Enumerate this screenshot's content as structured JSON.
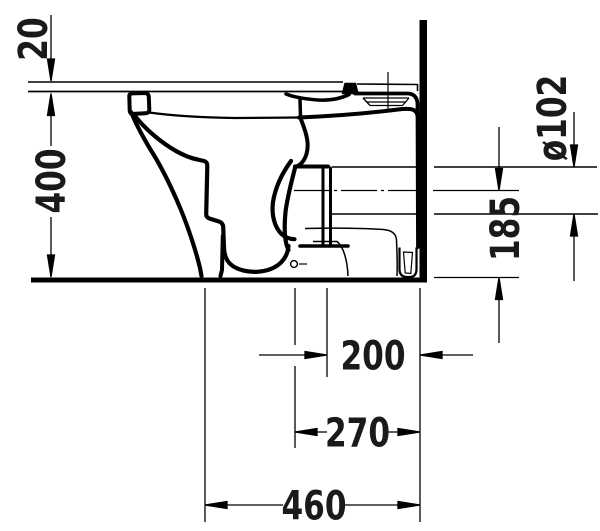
{
  "drawing": {
    "description": "Side-view technical dimension drawing of a floor-standing back-to-wall WC pan with horizontal outlet",
    "colors": {
      "line": "#000000",
      "background": "#ffffff"
    },
    "dimensions": {
      "seat_add_height": "20",
      "bowl_height": "400",
      "outlet_diameter": "ø102",
      "outlet_center_height": "185",
      "outlet_to_wall": "200",
      "fixing_distance": "270",
      "overall_depth": "460"
    }
  }
}
